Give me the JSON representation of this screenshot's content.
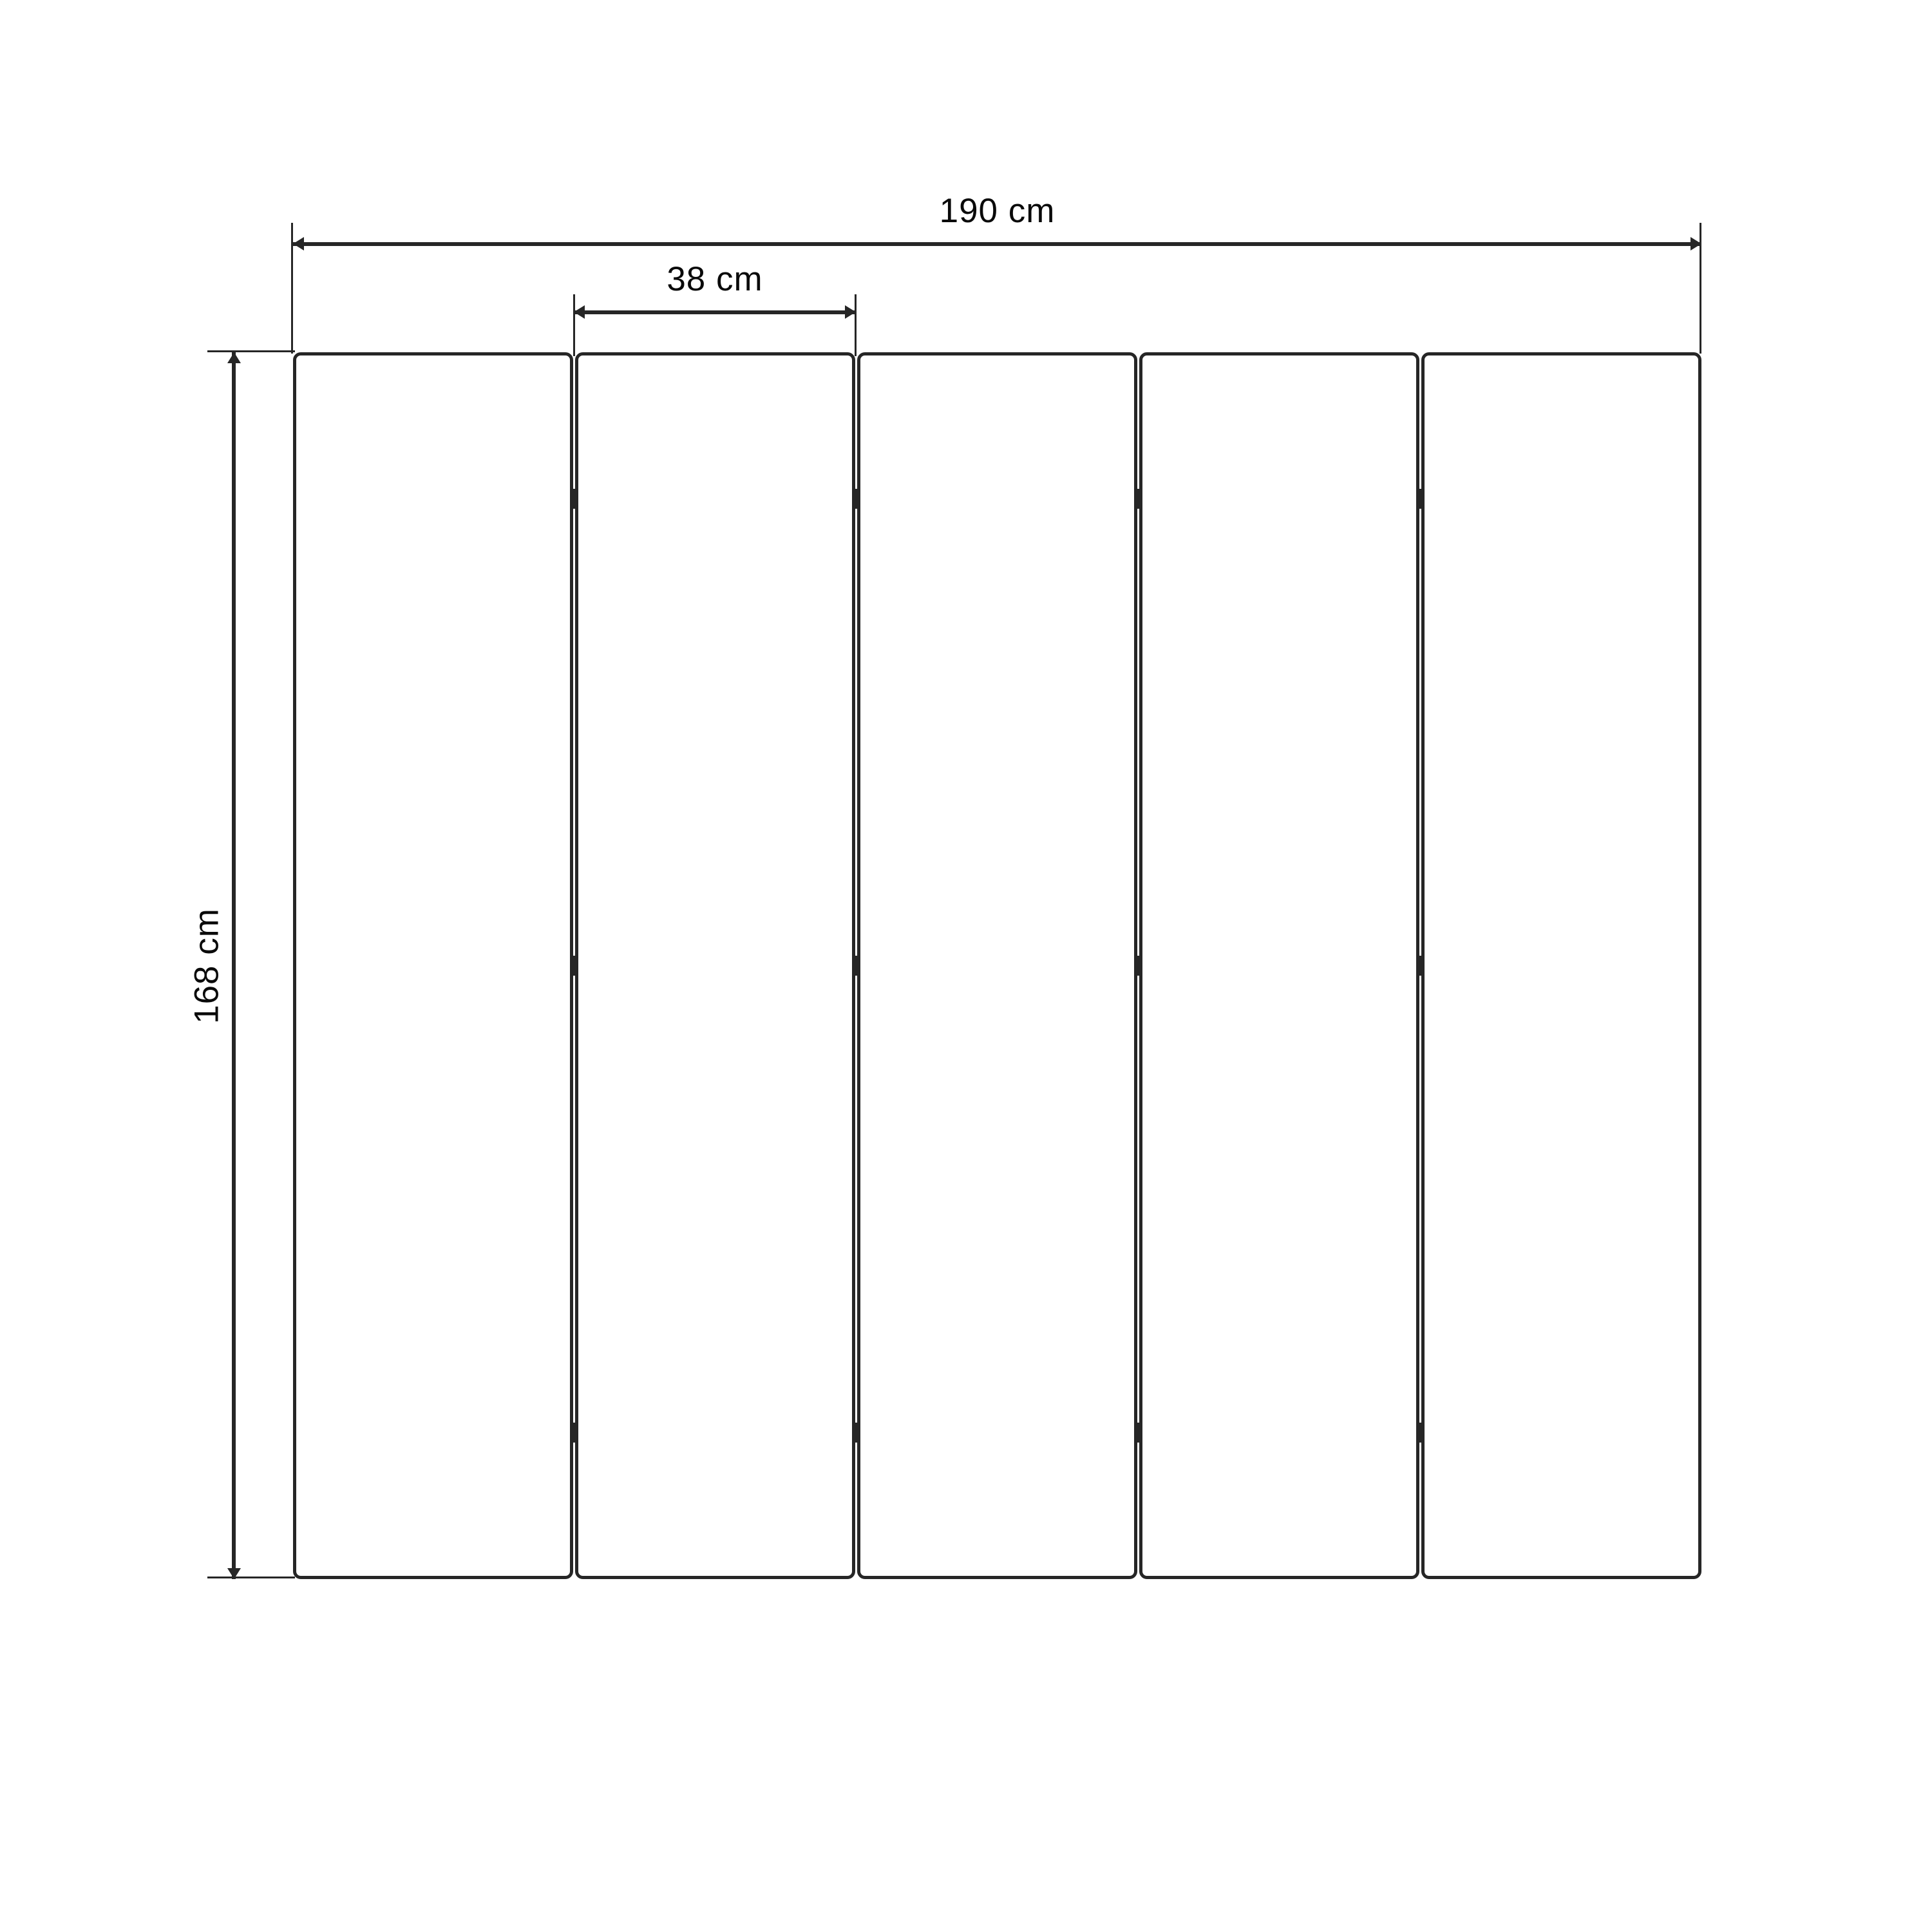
{
  "dimensions": {
    "total_width": {
      "label": "190 cm",
      "value": 190,
      "unit": "cm"
    },
    "panel_width": {
      "label": "38 cm",
      "value": 38,
      "unit": "cm"
    },
    "height": {
      "label": "168 cm",
      "value": 168,
      "unit": "cm"
    }
  },
  "panels": {
    "count": 5,
    "gap_count": 4,
    "hinges_per_gap": 3
  },
  "theme": {
    "line_color": "#262626",
    "text_color": "#0a0a0a",
    "background_color": "#ffffff"
  }
}
